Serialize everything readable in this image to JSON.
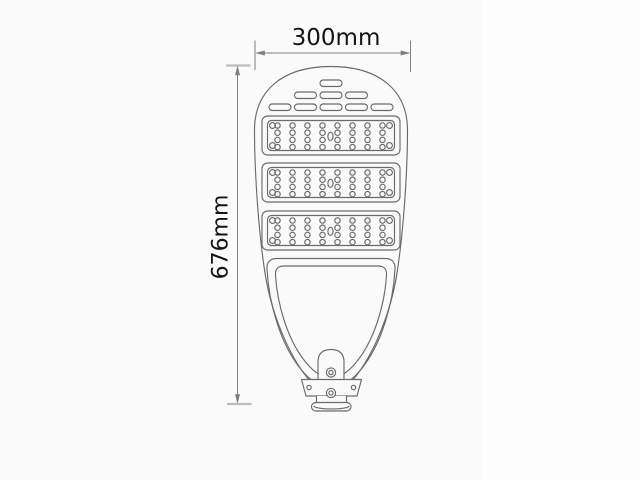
{
  "dimension_labels": {
    "width": "300mm",
    "height": "676mm"
  },
  "colors": {
    "background": "#fafafa",
    "outline": "#6a6a6a",
    "dimension_line": "#7f7f7f",
    "extension_tick": "#bdbdbd",
    "text": "#141414"
  },
  "lamp": {
    "vent_slot_rows": [
      1,
      3,
      5
    ],
    "led_panels": {
      "count": 3,
      "led_columns": 8,
      "led_rows": 4,
      "corner_screws_per_panel": 4,
      "center_hole_per_panel": 1
    },
    "mounting_bracket": {
      "bolts": 2,
      "wing_screws": 2
    }
  }
}
